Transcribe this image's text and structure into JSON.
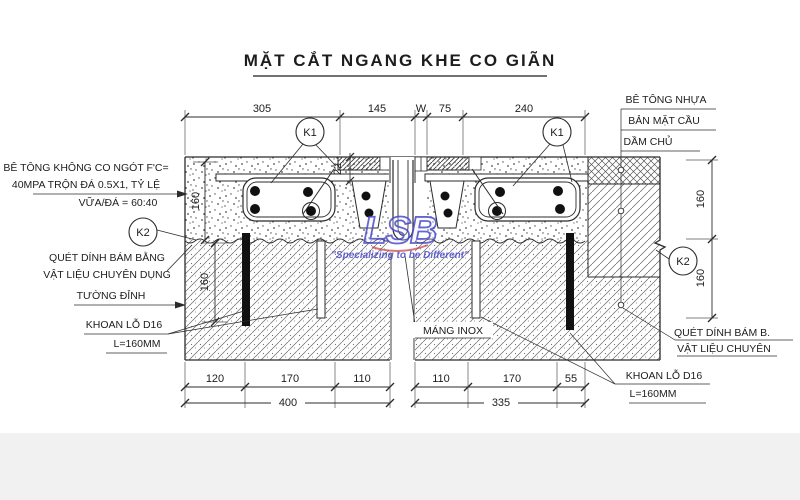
{
  "title": "MẶT CẮT NGANG KHE CO GIÃN",
  "dims": {
    "top": [
      "305",
      "145",
      "W",
      "75",
      "240"
    ],
    "plate": "22",
    "left_vertical": [
      "160",
      "160"
    ],
    "right_vertical": [
      "160",
      "160"
    ],
    "bottom_left": {
      "segments": [
        "120",
        "170",
        "110"
      ],
      "total": "400"
    },
    "bottom_right": {
      "segments": [
        "110",
        "170",
        "55"
      ],
      "total": "335"
    }
  },
  "markers": {
    "k1": "K1",
    "k2": "K2"
  },
  "callouts": {
    "left": {
      "concrete1": "BÊ TÔNG KHÔNG CO NGÓT F'C=",
      "concrete2": "40MPA TRỘN ĐÁ 0.5X1, TỶ LỆ",
      "concrete3": "VỮA/ĐÁ = 60:40",
      "bond1": "QUÉT DÍNH BÁM BẰNG",
      "bond2": "VẬT LIỆU CHUYÊN DỤNG",
      "wall": "TƯỜNG ĐỈNH",
      "drill": "KHOAN LỖ D16",
      "drill_len": "L=160MM"
    },
    "right": {
      "asphalt": "BÊ TÔNG NHỰA",
      "deck": "BẢN MẶT CẦU",
      "girder": "DẦM CHỦ",
      "bond1": "QUÉT DÍNH BÁM B.",
      "bond2": "VẬT LIỆU CHUYÊN",
      "drill": "KHOAN LỖ D16",
      "drill_len": "L=160MM"
    },
    "center": {
      "gutter": "MÁNG INOX"
    }
  },
  "watermark": {
    "logo": "LSB",
    "tagline": "\"Specializing to be Different\"",
    "color": "#4b4bc8",
    "accent": "#c23a3a"
  },
  "colors": {
    "ink": "#2b2b2b",
    "hatch": "#666666"
  }
}
